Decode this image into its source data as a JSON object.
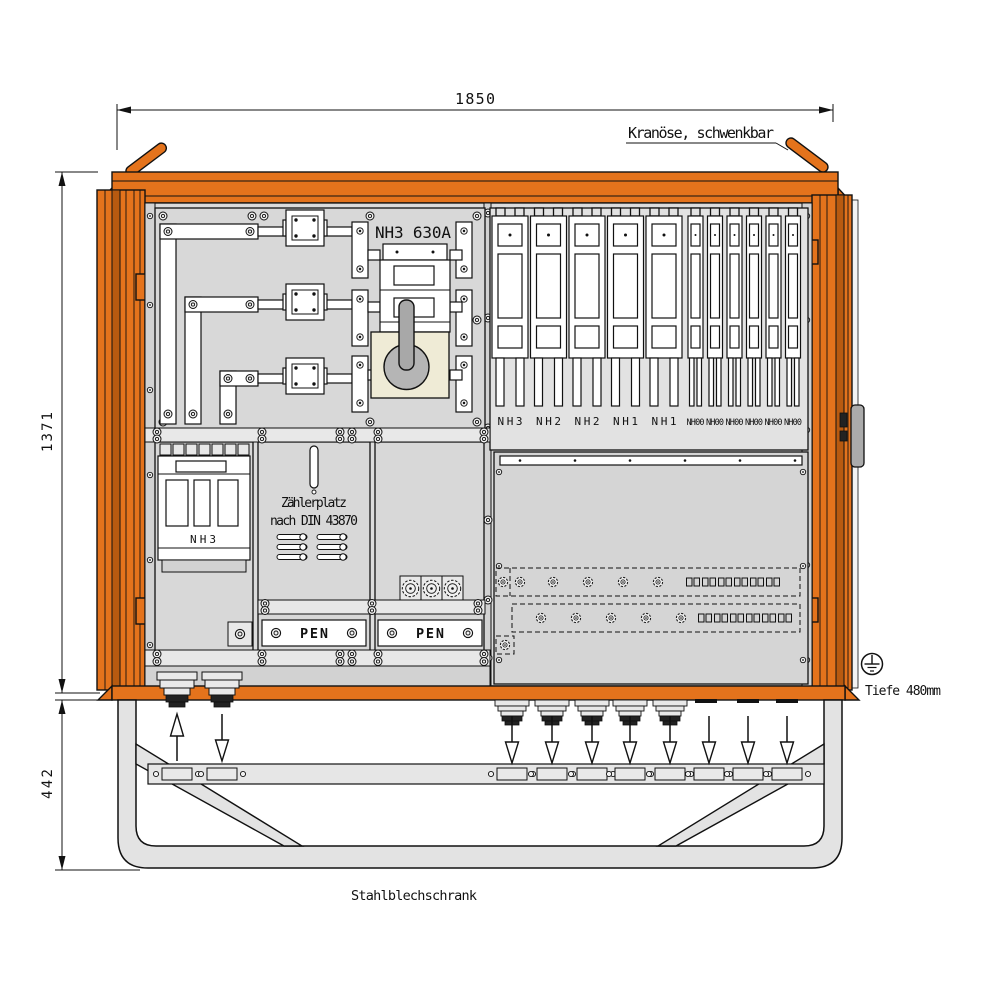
{
  "drawing": {
    "type": "technical-front-view",
    "subject": "distribution cabinet on tube stand"
  },
  "dims": {
    "width": "1850",
    "height": "1371",
    "stand": "442",
    "depth": "Tiefe 480mm"
  },
  "labels": {
    "crane": "Kranöse, schwenkbar",
    "main_switch": "NH3 630A",
    "meter1": "Zählerplatz",
    "meter2": "nach DIN 43870",
    "lower_switch": "NH3",
    "cabinet": "Stahlblechschrank"
  },
  "pen": [
    "PEN",
    "PEN"
  ],
  "strips": {
    "wide": [
      "NH3",
      "NH2",
      "NH2",
      "NH1",
      "NH1"
    ],
    "narrow": [
      "NH00",
      "NH00",
      "NH00",
      "NH00",
      "NH00",
      "NH00"
    ]
  },
  "icons": [
    "earth-symbol",
    "crane-lug",
    "cable-gland",
    "flow-arrow"
  ],
  "colors": {
    "cabinet_orange": "#E4731C",
    "orange_dark": "#B85A10",
    "panel_gray": "#D8D8D8",
    "light_gray": "#E2E2E2",
    "line_black": "#111111",
    "beige_plate": "#EFEBD6",
    "handle_gray": "#ABABAB",
    "background": "#FFFFFF"
  }
}
